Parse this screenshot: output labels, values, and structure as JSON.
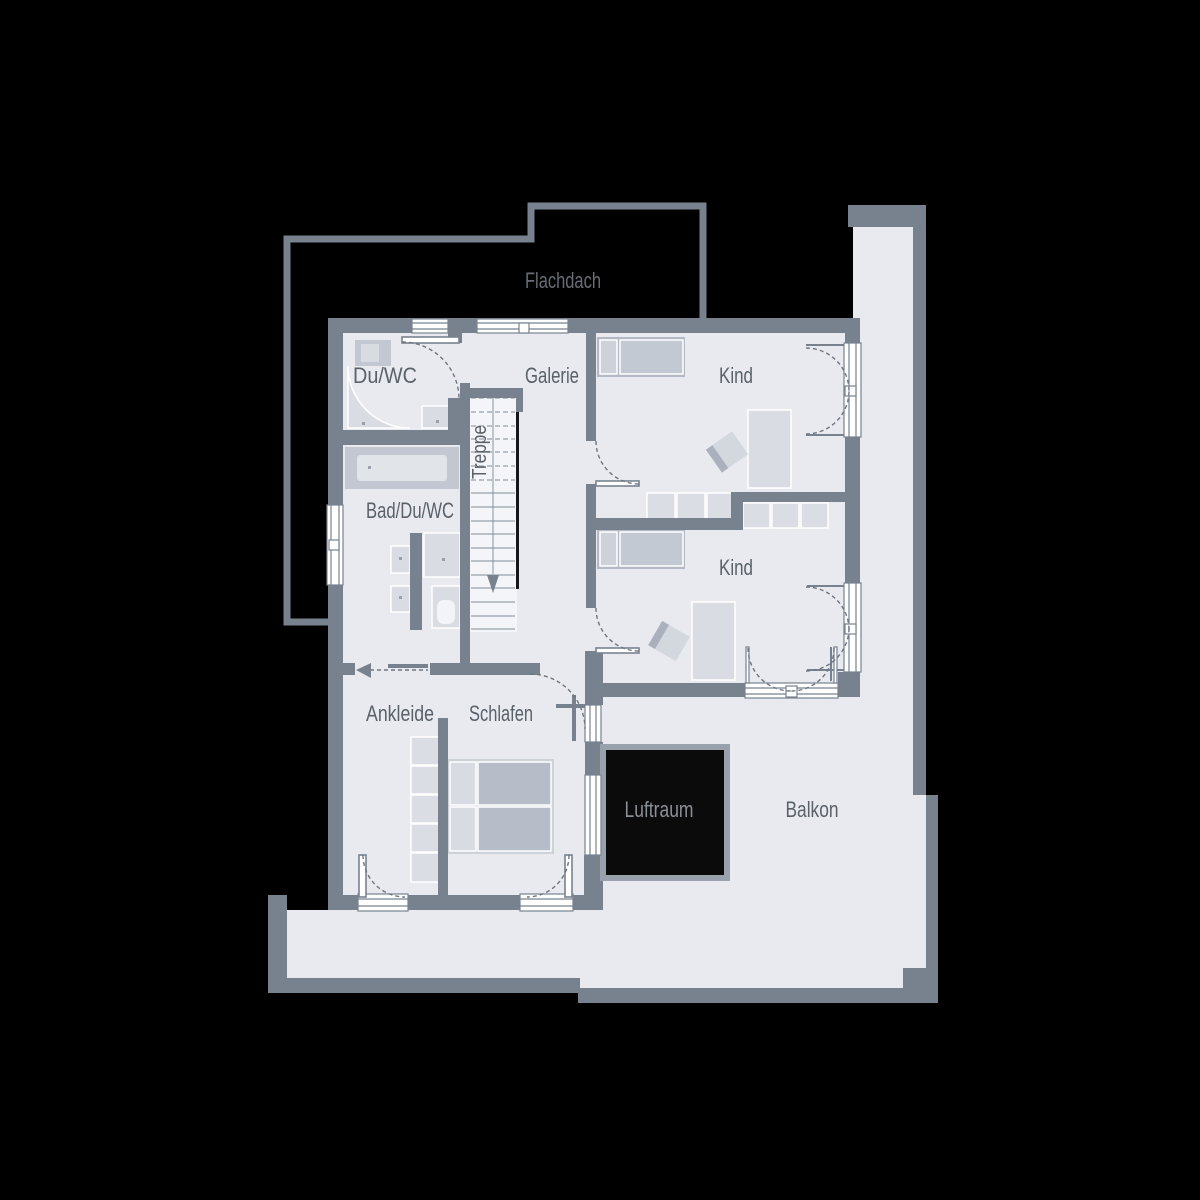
{
  "palette": {
    "background": "#000000",
    "wall": "#78828F",
    "floor": "#E8EAEF",
    "window": "#FFFFFF",
    "furniture_light": "#D9DCE2",
    "furniture_medium": "#C2C7D1",
    "furniture_dark": "#B3BAC6",
    "void_fill": "#0B0B0C",
    "label_text": "#5A6169",
    "label_on_dark": "#8B9097"
  },
  "rooms": {
    "flachdach": {
      "label": "Flachdach"
    },
    "du_wc": {
      "label": "Du/WC"
    },
    "galerie": {
      "label": "Galerie"
    },
    "treppe": {
      "label": "Treppe"
    },
    "kind_1": {
      "label": "Kind"
    },
    "kind_2": {
      "label": "Kind"
    },
    "bad_du_wc": {
      "label": "Bad/Du/WC"
    },
    "ankleide": {
      "label": "Ankleide"
    },
    "schlafen": {
      "label": "Schlafen"
    },
    "luftraum": {
      "label": "Luftraum"
    },
    "balkon": {
      "label": "Balkon"
    }
  }
}
